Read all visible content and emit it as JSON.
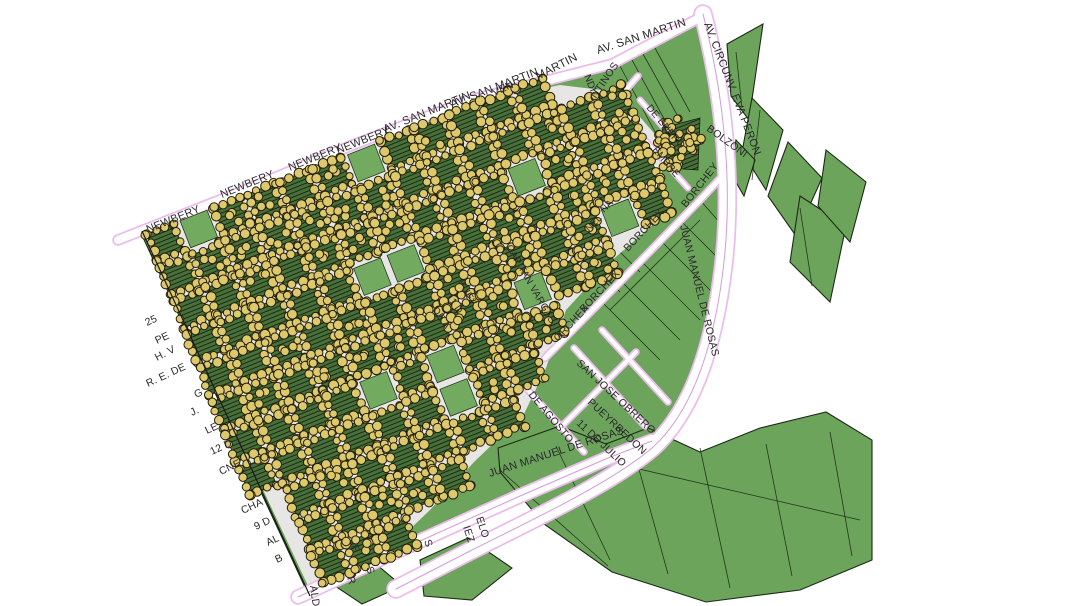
{
  "app": {
    "title": "GIS map view"
  },
  "colors": {
    "background": "#ffffff",
    "parcel_green": "#6ca45c",
    "parcel_outline": "#1d2a15",
    "block_base": "#47703a",
    "block_hatch": "#1c2a12",
    "park_green": "#72aa60",
    "urban_base": "#f5edf3",
    "dot_fill": "#ddc96b",
    "dot_stroke": "#231f0b",
    "road_fill": "#ffffff",
    "road_casing": "#ecbcec",
    "road_centerline": "#d49ada",
    "label_color": "#2a2a2a",
    "edge_line": "#1a1a1a"
  },
  "map": {
    "width": 1076,
    "height": 606,
    "footprint": [
      [
        118,
        241
      ],
      [
        206,
        205
      ],
      [
        290,
        172
      ],
      [
        380,
        136
      ],
      [
        470,
        100
      ],
      [
        560,
        72
      ],
      [
        612,
        62
      ],
      [
        703,
        14
      ],
      [
        714,
        80
      ],
      [
        730,
        170
      ],
      [
        722,
        268
      ],
      [
        700,
        360
      ],
      [
        664,
        430
      ],
      [
        640,
        450
      ],
      [
        608,
        458
      ],
      [
        520,
        496
      ],
      [
        400,
        550
      ],
      [
        330,
        583
      ],
      [
        310,
        598
      ],
      [
        140,
        231
      ]
    ],
    "islands": [
      [
        [
          727,
          44
        ],
        [
          763,
          24
        ],
        [
          749,
          120
        ],
        [
          731,
          96
        ]
      ],
      [
        [
          752,
          98
        ],
        [
          783,
          130
        ],
        [
          766,
          190
        ],
        [
          742,
          152
        ]
      ],
      [
        [
          788,
          142
        ],
        [
          822,
          178
        ],
        [
          796,
          236
        ],
        [
          768,
          196
        ]
      ],
      [
        [
          736,
          140
        ],
        [
          755,
          160
        ],
        [
          744,
          196
        ],
        [
          730,
          172
        ]
      ],
      [
        [
          800,
          196
        ],
        [
          846,
          226
        ],
        [
          830,
          302
        ],
        [
          790,
          262
        ]
      ],
      [
        [
          826,
          150
        ],
        [
          866,
          182
        ],
        [
          850,
          242
        ],
        [
          818,
          206
        ]
      ],
      [
        [
          498,
          448
        ],
        [
          560,
          426
        ],
        [
          606,
          444
        ],
        [
          648,
          428
        ],
        [
          700,
          452
        ],
        [
          760,
          428
        ],
        [
          826,
          412
        ],
        [
          872,
          440
        ],
        [
          872,
          560
        ],
        [
          800,
          590
        ],
        [
          706,
          602
        ],
        [
          612,
          572
        ],
        [
          544,
          524
        ],
        [
          500,
          472
        ]
      ],
      [
        [
          420,
          560
        ],
        [
          468,
          538
        ],
        [
          512,
          568
        ],
        [
          472,
          600
        ],
        [
          424,
          596
        ]
      ],
      [
        [
          332,
          584
        ],
        [
          376,
          564
        ],
        [
          402,
          586
        ],
        [
          362,
          604
        ]
      ]
    ],
    "parcel_lines": [
      [
        620,
        66,
        655,
        132
      ],
      [
        632,
        60,
        668,
        126
      ],
      [
        643,
        54,
        680,
        120
      ],
      [
        655,
        48,
        690,
        112
      ],
      [
        600,
        300,
        660,
        360
      ],
      [
        620,
        280,
        680,
        340
      ],
      [
        640,
        260,
        700,
        320
      ],
      [
        660,
        240,
        712,
        292
      ],
      [
        680,
        220,
        722,
        262
      ],
      [
        700,
        200,
        728,
        232
      ],
      [
        610,
        310,
        700,
        220
      ],
      [
        566,
        238,
        620,
        292
      ],
      [
        586,
        218,
        640,
        272
      ],
      [
        556,
        446,
        610,
        560
      ],
      [
        632,
        444,
        668,
        574
      ],
      [
        700,
        448,
        730,
        588
      ],
      [
        766,
        444,
        792,
        576
      ],
      [
        830,
        432,
        852,
        556
      ],
      [
        500,
        470,
        608,
        566
      ],
      [
        600,
        460,
        860,
        520
      ],
      [
        736,
        52,
        742,
        108
      ],
      [
        760,
        110,
        752,
        180
      ],
      [
        800,
        208,
        812,
        286
      ]
    ],
    "urban": {
      "polygon": [
        [
          142,
          232
        ],
        [
          240,
          192
        ],
        [
          340,
          152
        ],
        [
          470,
          103
        ],
        [
          560,
          85
        ],
        [
          618,
          92
        ],
        [
          660,
          140
        ],
        [
          664,
          215
        ],
        [
          610,
          262
        ],
        [
          566,
          310
        ],
        [
          546,
          368
        ],
        [
          524,
          414
        ],
        [
          474,
          462
        ],
        [
          430,
          510
        ],
        [
          386,
          552
        ],
        [
          330,
          588
        ],
        [
          310,
          590
        ],
        [
          160,
          270
        ]
      ],
      "origin": [
        142,
        232
      ],
      "angle_deg": -21.5,
      "cols": 14,
      "rows": 11,
      "cell": 36,
      "gap": 7,
      "seed": 11,
      "park_ratio": 0.08,
      "dot_step": 8.5,
      "dot_radius": 4.2
    },
    "clusters": [
      {
        "x": 678,
        "y": 145,
        "rx": 24,
        "ry": 28,
        "count": 44,
        "pad_polygon": [
          [
            662,
            128
          ],
          [
            700,
            118
          ],
          [
            698,
            170
          ],
          [
            668,
            168
          ]
        ]
      }
    ],
    "roads": [
      {
        "name": "av-san-martin",
        "d": "M118,240 L245,190 L350,146 L470,100 L612,64 L703,16",
        "width": 8,
        "center": false
      },
      {
        "name": "av-circunv-eva-peron",
        "d": "M703,14 C720,80 734,170 724,262 C714,352 690,414 652,448 C612,482 540,516 470,551 L396,589",
        "width": 16,
        "center": true
      },
      {
        "name": "juan-manuel-de-rosas",
        "d": "M298,597 L400,550 L520,496 L608,458 L652,441",
        "width": 12,
        "center": true
      },
      {
        "name": "borchex",
        "d": "M545,358 L622,280 L700,200 L728,170",
        "width": 5,
        "center": false
      },
      {
        "name": "argentinos",
        "d": "M566,158 L638,76",
        "width": 4,
        "center": false
      },
      {
        "name": "san-jose-obrero-street",
        "d": "M574,348 L645,426",
        "width": 4,
        "center": false
      },
      {
        "name": "pueyrredon-street",
        "d": "M602,330 L668,402",
        "width": 4,
        "center": false
      },
      {
        "name": "once-de-julio-street",
        "d": "M560,428 L636,352",
        "width": 4,
        "center": false
      },
      {
        "name": "de-agosto-street",
        "d": "M528,390 L584,452",
        "width": 4,
        "center": false
      },
      {
        "name": "de-enero-street",
        "d": "M640,100 L676,142",
        "width": 3.5,
        "center": false
      },
      {
        "name": "embre-street",
        "d": "M645,140 L688,188",
        "width": 3.5,
        "center": false
      }
    ],
    "labels": [
      {
        "t": "NEWBERY",
        "x": 148,
        "y": 233,
        "r": -22,
        "s": 11
      },
      {
        "t": "NEWBERY",
        "x": 222,
        "y": 198,
        "r": -22,
        "s": 11
      },
      {
        "t": "NEWBERY",
        "x": 290,
        "y": 171,
        "r": -22,
        "s": 11
      },
      {
        "t": "NEWBERY",
        "x": 338,
        "y": 154,
        "r": -22,
        "s": 11
      },
      {
        "t": "AV. SAN MARTIN",
        "x": 385,
        "y": 133,
        "r": -22,
        "s": 11.5
      },
      {
        "t": "AV. SAN MARTIN",
        "x": 452,
        "y": 108,
        "r": -21,
        "s": 11.5
      },
      {
        "t": "VEN",
        "x": 494,
        "y": 96,
        "r": -24,
        "s": 10.5
      },
      {
        "t": "MARTIN",
        "x": 538,
        "y": 80,
        "r": -27,
        "s": 11.5
      },
      {
        "t": "AV. SAN MARTIN",
        "x": 598,
        "y": 54,
        "r": -18,
        "s": 11.5
      },
      {
        "t": "AV. CIRCUNV. EVA PERON",
        "x": 704,
        "y": 24,
        "r": 69,
        "s": 11
      },
      {
        "t": "NTINOS",
        "x": 596,
        "y": 99,
        "r": -56,
        "s": 10.5
      },
      {
        "t": "NDI",
        "x": 584,
        "y": 76,
        "r": 68,
        "s": 10
      },
      {
        "t": "DE ENERO",
        "x": 646,
        "y": 108,
        "r": 50,
        "s": 10
      },
      {
        "t": "EMBRE",
        "x": 652,
        "y": 150,
        "r": 50,
        "s": 10
      },
      {
        "t": "BOLZONI",
        "x": 706,
        "y": 130,
        "r": 36,
        "s": 10.5
      },
      {
        "t": "BORCHEY",
        "x": 686,
        "y": 208,
        "r": -52,
        "s": 10.5
      },
      {
        "t": "BORCHEX",
        "x": 628,
        "y": 252,
        "r": -47,
        "s": 10.5
      },
      {
        "t": "BORCHEX",
        "x": 584,
        "y": 313,
        "r": -47,
        "s": 10.5
      },
      {
        "t": "ORCHEX",
        "x": 558,
        "y": 342,
        "r": -47,
        "s": 10.5
      },
      {
        "t": "JUAN MANUEL DE ROSAS",
        "x": 680,
        "y": 226,
        "r": 76,
        "s": 10.5
      },
      {
        "t": "NA",
        "x": 604,
        "y": 213,
        "r": -45,
        "s": 9.5
      },
      {
        "t": "NEL",
        "x": 589,
        "y": 232,
        "r": -45,
        "s": 9.5
      },
      {
        "t": "CAPITAN VARGAS",
        "x": 506,
        "y": 247,
        "r": 60,
        "s": 10
      },
      {
        "t": "PUEY",
        "x": 458,
        "y": 282,
        "r": 62,
        "s": 10
      },
      {
        "t": "11 D",
        "x": 446,
        "y": 297,
        "r": 55,
        "s": 10
      },
      {
        "t": "DE A",
        "x": 432,
        "y": 310,
        "r": 55,
        "s": 10
      },
      {
        "t": "DE AGOSTO",
        "x": 528,
        "y": 395,
        "r": 50,
        "s": 10.5
      },
      {
        "t": "SAN JOSE OBRERO",
        "x": 576,
        "y": 364,
        "r": 43,
        "s": 10.5
      },
      {
        "t": "PUEYRREDON",
        "x": 587,
        "y": 403,
        "r": 43,
        "s": 10.5
      },
      {
        "t": "11 DE JULIO",
        "x": 576,
        "y": 424,
        "r": 43,
        "s": 10.5
      },
      {
        "t": "JUAN MANUEL DE ROSAS",
        "x": 490,
        "y": 477,
        "r": -18,
        "s": 11
      },
      {
        "t": "25",
        "x": 147,
        "y": 326,
        "r": -25,
        "s": 10.5
      },
      {
        "t": "PE",
        "x": 157,
        "y": 344,
        "r": -25,
        "s": 10.5
      },
      {
        "t": "H. V",
        "x": 157,
        "y": 361,
        "r": -27,
        "s": 10.5
      },
      {
        "t": "R. E. DE",
        "x": 148,
        "y": 387,
        "r": -25,
        "s": 10.5
      },
      {
        "t": "G",
        "x": 196,
        "y": 398,
        "r": -25,
        "s": 10.5
      },
      {
        "t": "J.",
        "x": 192,
        "y": 416,
        "r": -25,
        "s": 10.5
      },
      {
        "t": "LE",
        "x": 207,
        "y": 434,
        "r": -25,
        "s": 10.5
      },
      {
        "t": "12 D",
        "x": 212,
        "y": 455,
        "r": -25,
        "s": 10.5
      },
      {
        "t": "CNE",
        "x": 221,
        "y": 475,
        "r": -25,
        "s": 10.5
      },
      {
        "t": "CHA",
        "x": 243,
        "y": 514,
        "r": -25,
        "s": 10.5
      },
      {
        "t": "9 D",
        "x": 256,
        "y": 530,
        "r": -25,
        "s": 10.5
      },
      {
        "t": "AL",
        "x": 268,
        "y": 546,
        "r": -25,
        "s": 10.5
      },
      {
        "t": "B",
        "x": 277,
        "y": 563,
        "r": -25,
        "s": 10.5
      },
      {
        "t": "ALD",
        "x": 310,
        "y": 586,
        "r": 82,
        "s": 10.5
      },
      {
        "t": "R",
        "x": 347,
        "y": 578,
        "r": 70,
        "s": 10.5
      },
      {
        "t": "S",
        "x": 366,
        "y": 568,
        "r": 70,
        "s": 10.5
      },
      {
        "t": "F",
        "x": 351,
        "y": 546,
        "r": 70,
        "s": 10.5
      },
      {
        "t": "S",
        "x": 424,
        "y": 541,
        "r": 70,
        "s": 10.5
      },
      {
        "t": "IEZ",
        "x": 463,
        "y": 527,
        "r": 72,
        "s": 10.5
      },
      {
        "t": "ELO",
        "x": 476,
        "y": 518,
        "r": 72,
        "s": 10.5
      }
    ]
  }
}
